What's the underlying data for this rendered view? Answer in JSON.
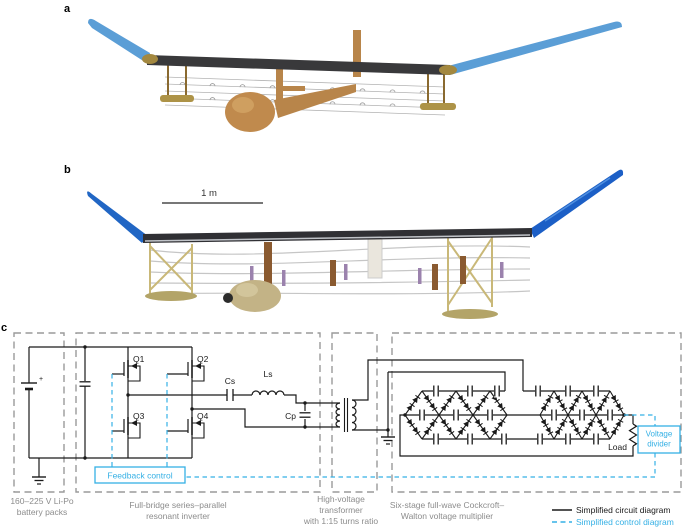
{
  "figure": {
    "panel_a_label": "a",
    "panel_b_label": "b",
    "panel_c_label": "c",
    "scale_bar_label": "1 m"
  },
  "circuit": {
    "transistors": [
      "Q1",
      "Q2",
      "Q3",
      "Q4"
    ],
    "components": {
      "battery_plus": "+",
      "cs": "Cs",
      "ls": "Ls",
      "cp": "Cp",
      "load": "Load"
    },
    "boxes": {
      "feedback": "Feedback control",
      "voltage_divider_line1": "Voltage",
      "voltage_divider_line2": "divider"
    },
    "captions": {
      "battery": "160–225 V Li-Po\nbattery packs",
      "inverter": "Full-bridge series–parallel\nresonant inverter",
      "transformer": "High-voltage\ntransformer\nwith 1:15 turns ratio",
      "multiplier": "Six-stage full-wave Cockcroft–\nWalton voltage multiplier"
    },
    "legend": {
      "circuit_label": "Simplified circuit diagram",
      "control_label": "Simplified control diagram"
    },
    "colors": {
      "wire": "#1a1a1a",
      "control_cyan": "#35b0e5",
      "box_dash_gray": "#9a9a9a",
      "caption_gray": "#8c8c8c"
    }
  },
  "aircraft": {
    "wing_dark": "#39393b",
    "wingtip_blue_render": "#5b9ed6",
    "wingtip_blue_photo": "#1c5fc6",
    "fuselage_render": "#c08a4d",
    "fuselage_photo": "#c3b386"
  }
}
